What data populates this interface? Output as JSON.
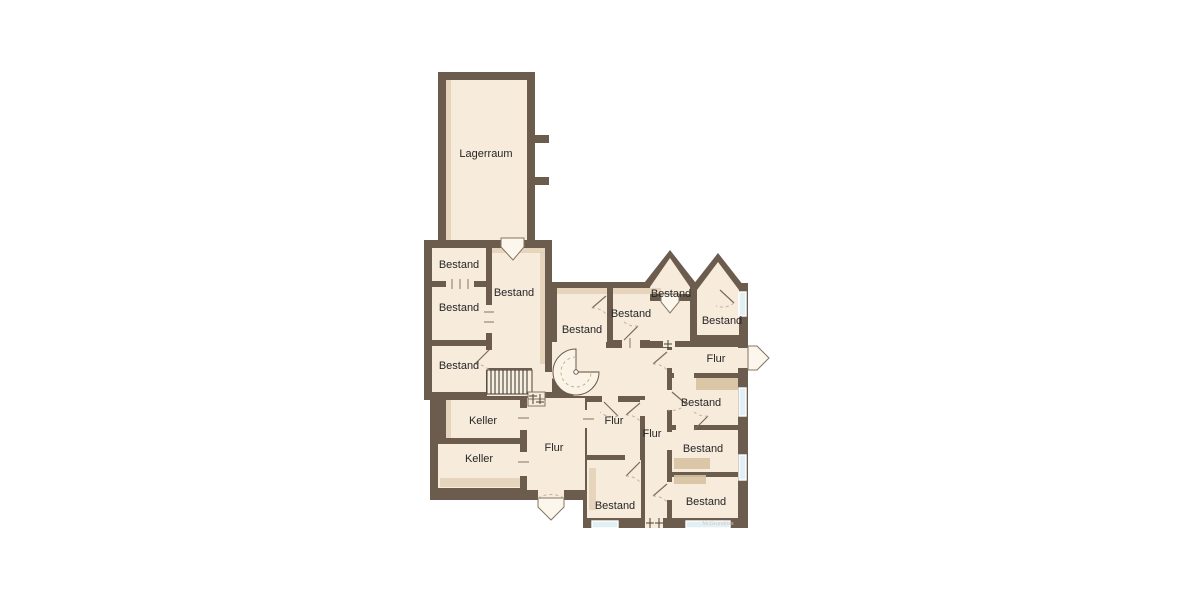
{
  "colors": {
    "wall": "#6b5c4e",
    "room": "#f7ebdc",
    "shade": "#d8c2a2",
    "window": "#e0f0f5",
    "leaf": "#fcf6ec",
    "door_dash": "#c2b194",
    "label": "#262626",
    "watermark": "#d6ccc0"
  },
  "plan": {
    "watermark": "McGrundriss",
    "rooms": [
      {
        "label": "Lagerraum",
        "x": 486,
        "y": 157
      },
      {
        "label": "Bestand",
        "x": 459,
        "y": 268
      },
      {
        "label": "Bestand",
        "x": 459,
        "y": 311
      },
      {
        "label": "Bestand",
        "x": 459,
        "y": 369
      },
      {
        "label": "Bestand",
        "x": 514,
        "y": 296
      },
      {
        "label": "Keller",
        "x": 483,
        "y": 424
      },
      {
        "label": "Keller",
        "x": 479,
        "y": 462
      },
      {
        "label": "Flur",
        "x": 554,
        "y": 451
      },
      {
        "label": "Bestand",
        "x": 582,
        "y": 333
      },
      {
        "label": "Bestand",
        "x": 631,
        "y": 317
      },
      {
        "label": "Flur",
        "x": 614,
        "y": 424
      },
      {
        "label": "Flur",
        "x": 652,
        "y": 437
      },
      {
        "label": "Bestand",
        "x": 615,
        "y": 509
      },
      {
        "label": "Bestand",
        "x": 671,
        "y": 297
      },
      {
        "label": "Bestand",
        "x": 722,
        "y": 324
      },
      {
        "label": "Flur",
        "x": 716,
        "y": 362
      },
      {
        "label": "Bestand",
        "x": 701,
        "y": 406
      },
      {
        "label": "Bestand",
        "x": 703,
        "y": 452
      },
      {
        "label": "Bestand",
        "x": 706,
        "y": 505
      }
    ]
  }
}
